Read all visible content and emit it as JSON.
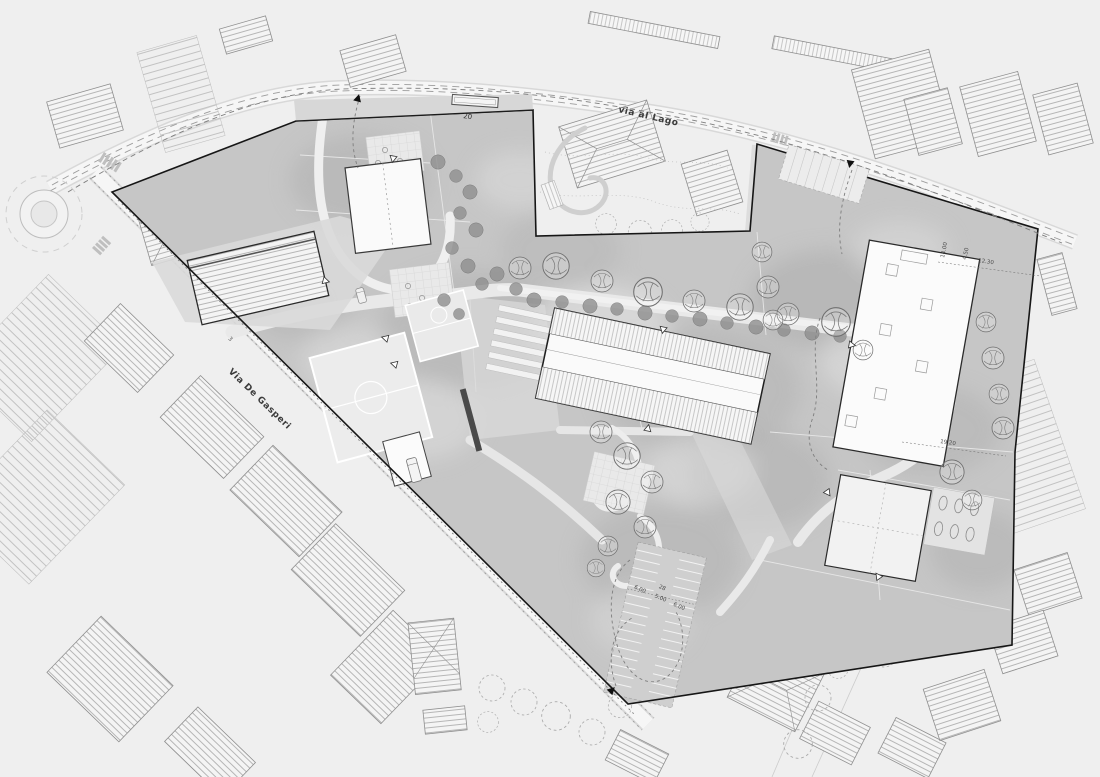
{
  "scene": {
    "type": "architectural-site-plan",
    "description": "Masterplan drawing of a school / public campus between two streets, with context housing, sports fields, tree-lined promenade and parking"
  },
  "streets": {
    "via_al_lago": "via al Lago",
    "via_de_gasperi": "Via De Gasperi"
  },
  "labels": {
    "bus_bay_number": "20",
    "parcel_number": "3",
    "dim_building_offset": "12.30",
    "dim_east_road": "19.20",
    "dim_court_width": "14.00",
    "dim_court_margin": "4.50",
    "dim_parking_row_west": "6.00",
    "dim_parking_aisle": "5.00",
    "dim_parking_row_east": "6.00",
    "parking_stall_count": "28"
  },
  "colors": {
    "background": "#efefef",
    "site_fill": "#c6c6c6",
    "site_dark_patch": "#b0b0b0",
    "site_light_patch": "#e3e3e3",
    "boundary": "#161616",
    "building_white": "#fafafa",
    "road_fill": "#f5f5f5",
    "tree_dark": "#8f8f8f",
    "marker_black": "#111111"
  }
}
